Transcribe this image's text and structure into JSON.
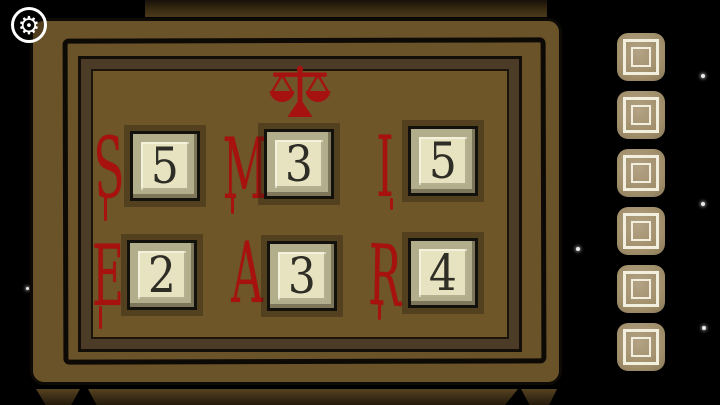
{
  "hud": {
    "settings_icon_glyph": "⚙"
  },
  "panel": {
    "balance_icon_name": "balance-scale-icon",
    "rows": [
      {
        "cells": [
          {
            "letter": "S",
            "number": "5"
          },
          {
            "letter": "M",
            "number": "3"
          },
          {
            "letter": "I",
            "number": "5"
          }
        ]
      },
      {
        "cells": [
          {
            "letter": "E",
            "number": "2"
          },
          {
            "letter": "A",
            "number": "3"
          },
          {
            "letter": "R",
            "number": "4"
          }
        ]
      }
    ]
  },
  "inventory": {
    "slot_count": "6"
  },
  "colors": {
    "letter_red": "#a8120e",
    "frame_brown": "#6b5329",
    "tile_frame_khaki": "#b2ad8a",
    "tile_face_cream": "#e7e3c1",
    "slot_tan": "#a29070"
  }
}
